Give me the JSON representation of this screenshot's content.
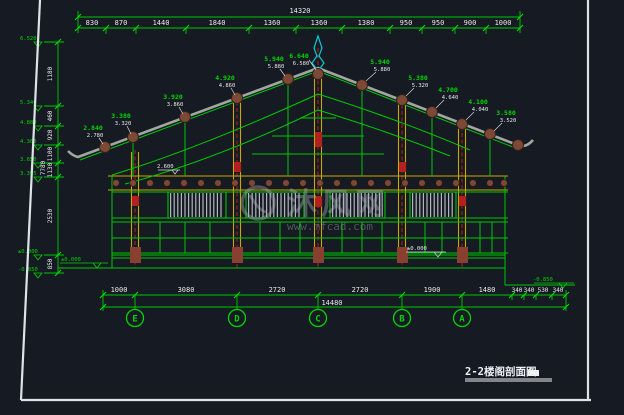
{
  "meta": {
    "app_context": "CAD drawing preview, dark model-space background",
    "drawing_type": "architectural cross-section of traditional Chinese timber building"
  },
  "colors": {
    "background": "#151a23",
    "line_green": "#00d400",
    "dim_text_white": "#e8e8e8",
    "column_yellow": "#c8a800",
    "section_red": "#cc2020",
    "purlin_brown": "#7d4937",
    "ornament_cyan": "#00cdd4",
    "roof_gray": "#a0a6a0",
    "sheet_frame_white": "#dfe3e6",
    "watermark_gray": "#aeb4bc"
  },
  "top_dim": {
    "overall": "14320",
    "segments": [
      "830",
      "870",
      "1440",
      "1840",
      "1360",
      "1360",
      "1380",
      "950",
      "950",
      "900",
      "1000"
    ]
  },
  "left_dim": {
    "overall": "7780",
    "segments": [
      "1180",
      "460",
      "920",
      "1100",
      "1130",
      "2530",
      "850"
    ],
    "elevations": [
      "6.520",
      "5.340",
      "4.880",
      "4.360",
      "3.650",
      "3.395",
      "±0.000",
      "-0.850"
    ]
  },
  "bottom_dim": {
    "overall": "14480",
    "segments": [
      "1000",
      "3080",
      "2720",
      "2720",
      "1900",
      "1480",
      "340",
      "340",
      "530",
      "340"
    ]
  },
  "grid": {
    "bubbles": [
      "E",
      "D",
      "C",
      "B",
      "A"
    ]
  },
  "roof": {
    "ridge": {
      "g": "6.640",
      "w": "6.580"
    },
    "left": [
      {
        "g": "2.840",
        "w": "2.780"
      },
      {
        "g": "3.380",
        "w": "3.320"
      },
      {
        "g": "3.920",
        "w": "3.860"
      },
      {
        "g": "4.920",
        "w": "4.860"
      },
      {
        "g": "5.940",
        "w": "5.880"
      }
    ],
    "right": [
      {
        "g": "5.940",
        "w": "5.880"
      },
      {
        "g": "5.380",
        "w": "5.320"
      },
      {
        "g": "4.700",
        "w": "4.640"
      },
      {
        "g": "4.100",
        "w": "4.040"
      },
      {
        "g": "3.580",
        "w": "3.520"
      }
    ]
  },
  "markers": {
    "left_zero": "±0.000",
    "floor_zero": "±0.000",
    "right_low": "-0.850",
    "eave": "2.600"
  },
  "watermark": {
    "brand": "沐风网",
    "url": "www.mfcad.com"
  },
  "title": {
    "text": "2-2楼阁剖面图"
  }
}
